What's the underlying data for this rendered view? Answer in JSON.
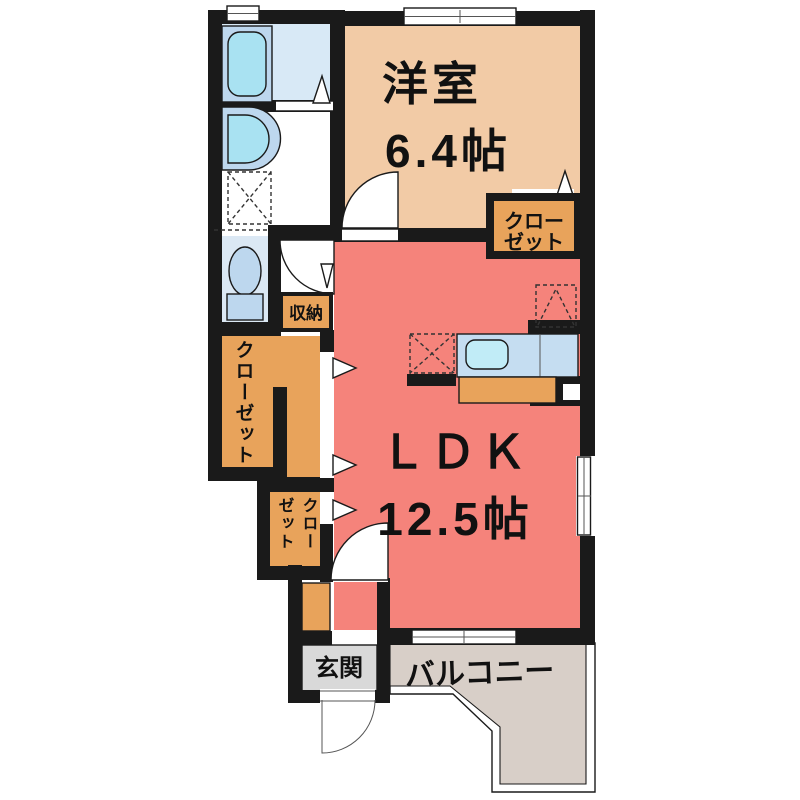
{
  "colors": {
    "wall": "#1a1a1a",
    "western_room": "#F2CBA6",
    "ldk": "#F5837B",
    "closet": "#E8A35B",
    "bathroom": "#D8E9F6",
    "fixture_panel": "#BDD7EE",
    "tub_water": "#A9E2F2",
    "toilet_room": "#DBE8F4",
    "kitchen_counter": "#C5DDF1",
    "sink_water": "#C1ECF7",
    "entrance": "#D9D9D9",
    "balcony": "#D8CFC8"
  },
  "labels": {
    "western_room_name": "洋室",
    "western_room_size": "6.4帖",
    "ldk_name": "ＬＤＫ",
    "ldk_size": "12.5帖",
    "closet_line1": "クロー",
    "closet_line2": "ゼット",
    "closet_vertical": "クローゼット",
    "entry_closet_col_right": "クロー",
    "entry_closet_col_left": "ゼット",
    "storage": "収納",
    "entrance": "玄関",
    "balcony": "バルコニー"
  }
}
